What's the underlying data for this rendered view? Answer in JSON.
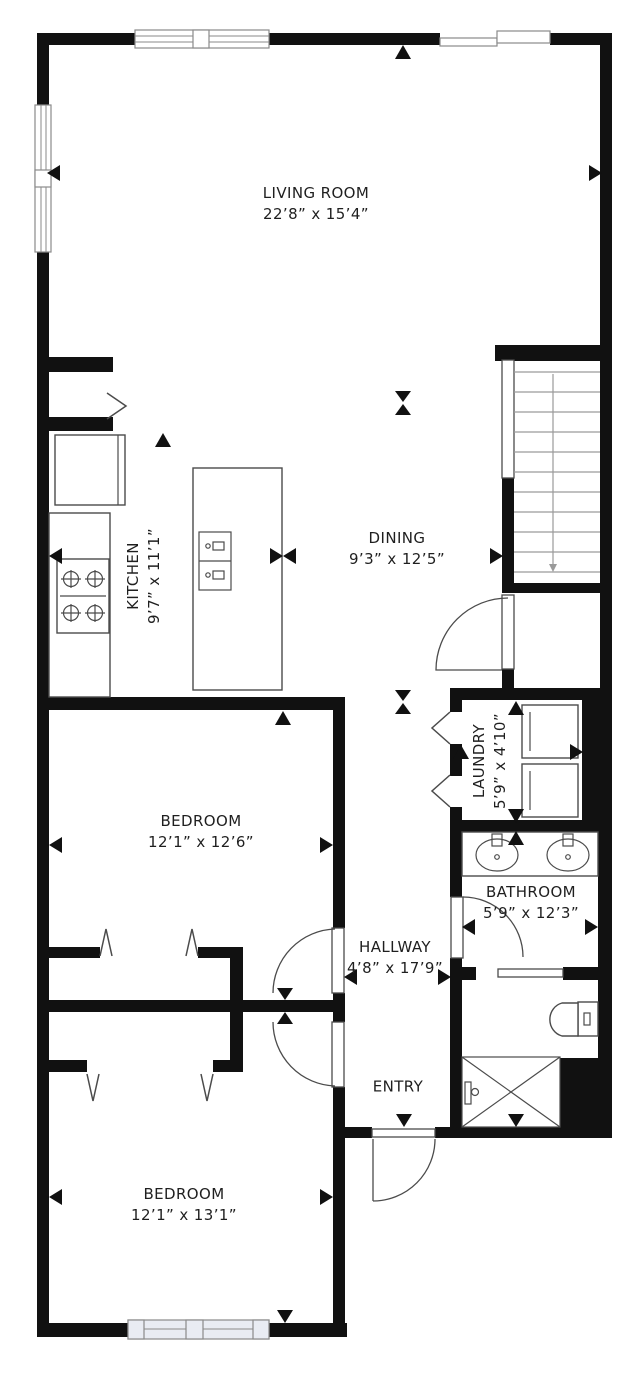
{
  "plan": {
    "type": "floor-plan",
    "colors": {
      "wall": "#111111",
      "line": "#4b4b4b",
      "window_fill": "#e9ecf3",
      "text": "#1f1f1f",
      "background": "#ffffff"
    },
    "rooms": {
      "living": {
        "name": "LIVING ROOM",
        "dims": "22’8” x 15’4”"
      },
      "kitchen": {
        "name": "KITCHEN",
        "dims": "9’7” x 11’1”"
      },
      "dining": {
        "name": "DINING",
        "dims": "9’3” x 12’5”"
      },
      "laundry": {
        "name": "LAUNDRY",
        "dims": "5’9” x 4’10”"
      },
      "bedroom1": {
        "name": "BEDROOM",
        "dims": "12’1” x 12’6”"
      },
      "bathroom": {
        "name": "BATHROOM",
        "dims": "5’9” x 12’3”"
      },
      "hallway": {
        "name": "HALLWAY",
        "dims": "4’8” x 17’9”"
      },
      "entry": {
        "name": "ENTRY",
        "dims": ""
      },
      "bedroom2": {
        "name": "BEDROOM",
        "dims": "12’1” x 13’1”"
      }
    },
    "fixtures": [
      "refrigerator",
      "cooktop",
      "kitchen-island-sink",
      "stairs",
      "understair-closet",
      "washer",
      "dryer",
      "vanity-double-sink",
      "toilet",
      "shower"
    ]
  }
}
